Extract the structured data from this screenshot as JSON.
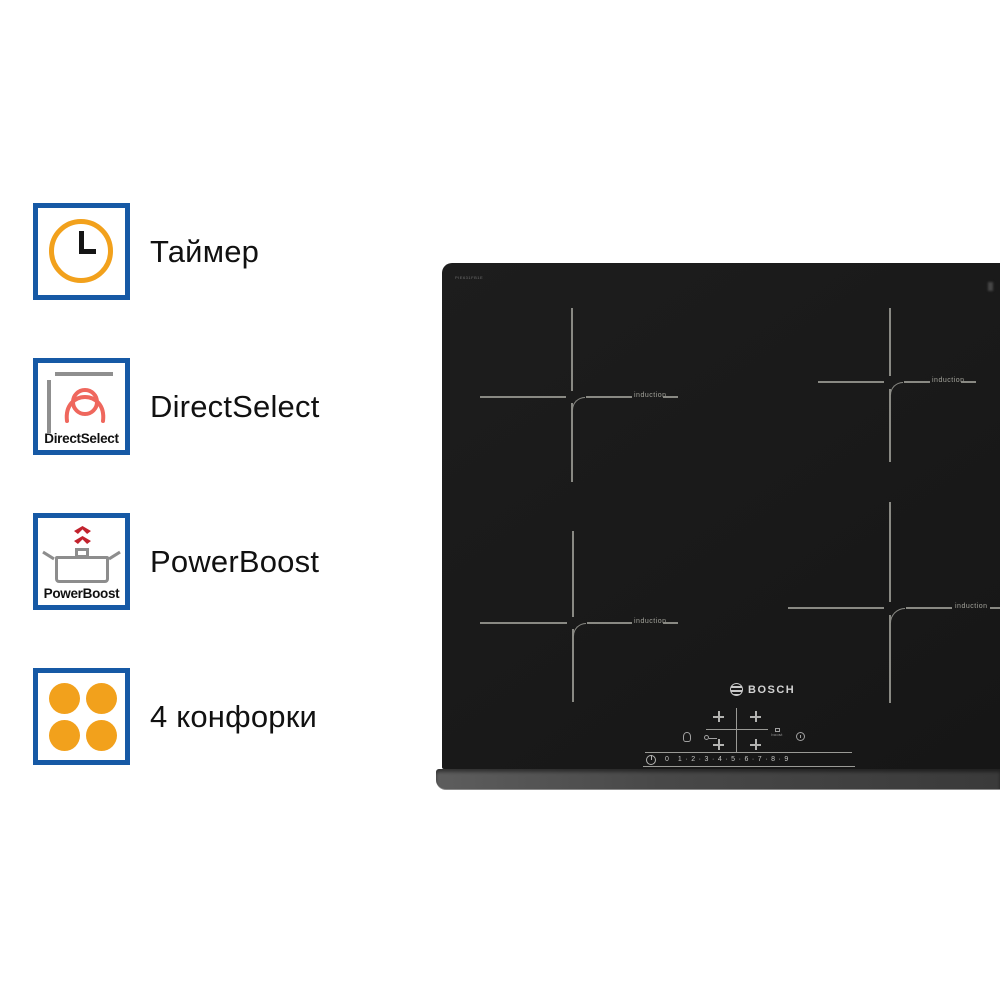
{
  "features": {
    "accent_color": "#1659a5",
    "orange_color": "#f2a11c",
    "coil_color": "#ef675d",
    "chevron_color": "#c2232e",
    "items": [
      {
        "label": "Таймер"
      },
      {
        "label": "DirectSelect",
        "badge_caption": "DirectSelect"
      },
      {
        "label": "PowerBoost",
        "badge_caption": "PowerBoost"
      },
      {
        "label": "4 конфорки"
      }
    ]
  },
  "cooktop": {
    "surface_color": "#1a1a1a",
    "marking_color": "#8f8f89",
    "model_label": "PIE631FB1E",
    "brand_logo": "BOSCH",
    "zone_labels": [
      "induction",
      "induction",
      "induction",
      "induction"
    ],
    "controls": {
      "boost_label": "boost",
      "slider_scale": "0   1 · 2 · 3 · 4 · 5 · 6 · 7 · 8 · 9"
    }
  }
}
